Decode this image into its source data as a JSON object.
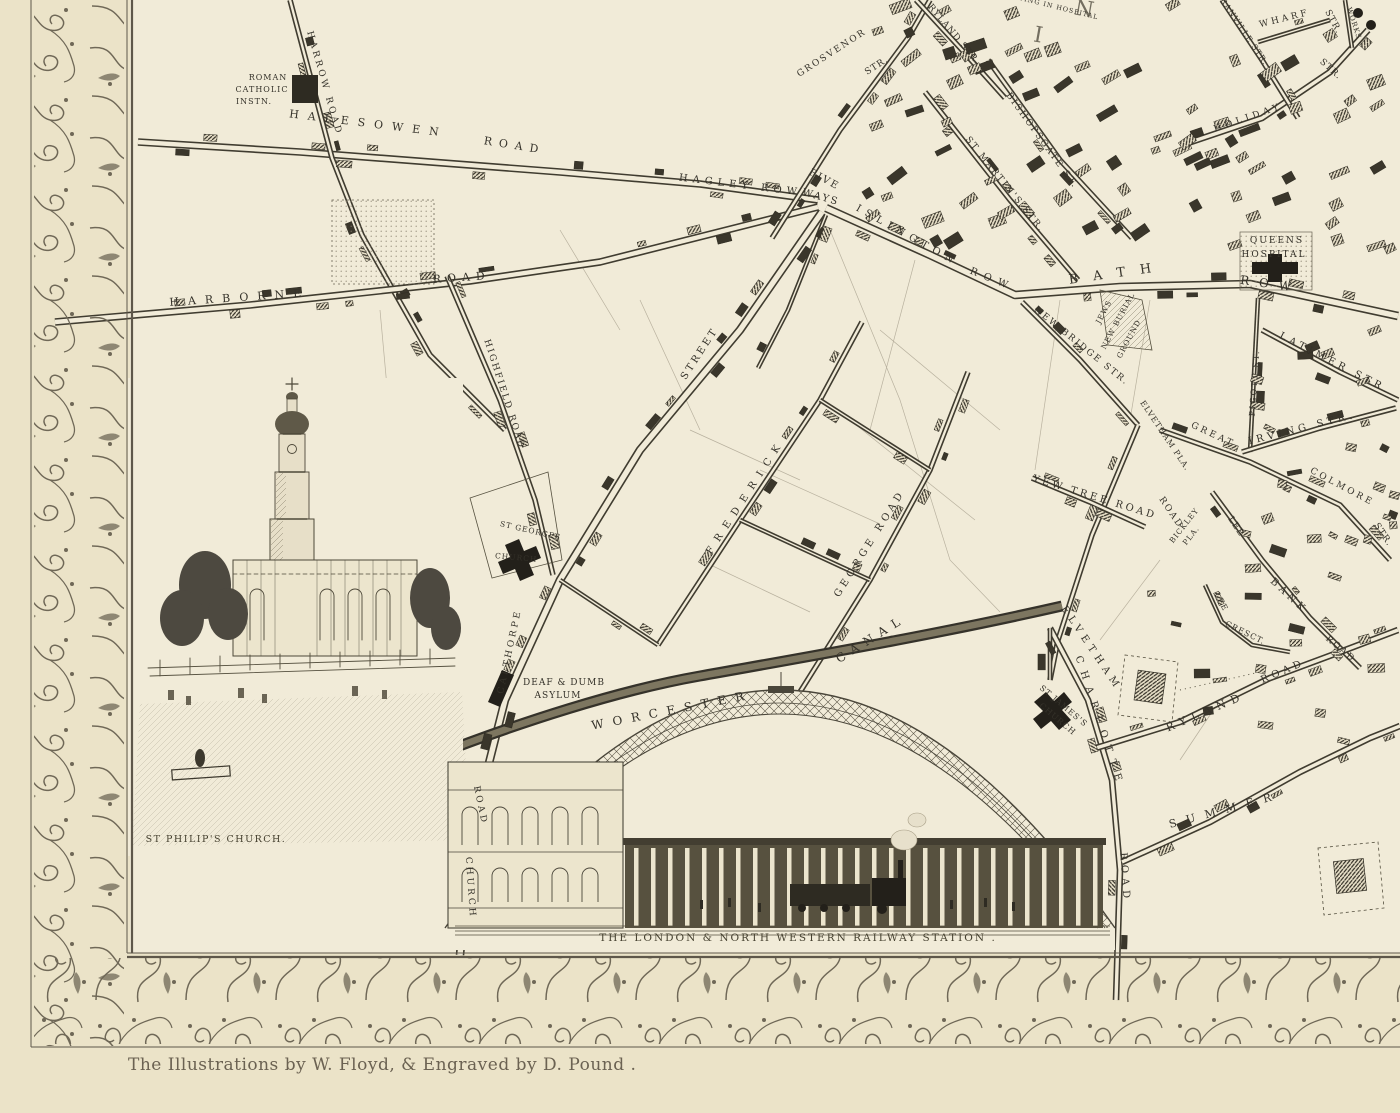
{
  "colors": {
    "paper": "#ebe3c8",
    "map_bg": "#f1ebd8",
    "ink": "#35322a",
    "border_ink": "#6f6857",
    "vignette_ink": "#4d4839"
  },
  "captions": {
    "church": "ST PHILIP'S CHURCH.",
    "station": "THE LONDON & NORTH WESTERN RAILWAY STATION .",
    "credit": "The Illustrations by W. Floyd, & Engraved by D. Pound ."
  },
  "map": {
    "labels": [
      {
        "t": "HARROW ROAD",
        "x": 322,
        "y": 84,
        "r": 74,
        "s": 9,
        "ls": 3
      },
      {
        "t": "HALESOWEN",
        "x": 368,
        "y": 127,
        "r": 7,
        "s": 11,
        "ls": 9
      },
      {
        "t": "ROAD",
        "x": 514,
        "y": 149,
        "r": 9,
        "s": 11,
        "ls": 7
      },
      {
        "t": "ROMAN",
        "x": 268,
        "y": 80,
        "r": 0,
        "s": 8,
        "ls": 1
      },
      {
        "t": "CATHOLIC",
        "x": 262,
        "y": 92,
        "r": 0,
        "s": 8,
        "ls": 1
      },
      {
        "t": "INSTN.",
        "x": 254,
        "y": 104,
        "r": 0,
        "s": 8,
        "ls": 1
      },
      {
        "t": "HAGLEY ROW",
        "x": 740,
        "y": 188,
        "r": 7,
        "s": 10,
        "ls": 5
      },
      {
        "t": "FIVE",
        "x": 823,
        "y": 182,
        "r": 28,
        "s": 10,
        "ls": 2
      },
      {
        "t": "WAYS",
        "x": 820,
        "y": 200,
        "r": 16,
        "s": 10,
        "ls": 2
      },
      {
        "t": "HARBORNE",
        "x": 240,
        "y": 301,
        "r": -4,
        "s": 11,
        "ls": 9
      },
      {
        "t": "ROAD",
        "x": 462,
        "y": 281,
        "r": -4,
        "s": 11,
        "ls": 6
      },
      {
        "t": "HIGHFIELD ROAD",
        "x": 502,
        "y": 395,
        "r": 72,
        "s": 9,
        "ls": 2
      },
      {
        "t": "GROSVENOR",
        "x": 833,
        "y": 55,
        "r": -33,
        "s": 9,
        "ls": 2
      },
      {
        "t": "STR.",
        "x": 878,
        "y": 68,
        "r": -33,
        "s": 9,
        "ls": 1
      },
      {
        "t": "RYLAND STR.",
        "x": 952,
        "y": 36,
        "r": 50,
        "s": 9,
        "ls": 1
      },
      {
        "t": "ST MARTIN'S STR.",
        "x": 1003,
        "y": 186,
        "r": 51,
        "s": 9,
        "ls": 2
      },
      {
        "t": "BISHOPSGATE ST.",
        "x": 1040,
        "y": 142,
        "r": 54,
        "s": 9,
        "ls": 2
      },
      {
        "t": "ISLINGTON",
        "x": 906,
        "y": 238,
        "r": 29,
        "s": 10,
        "ls": 6
      },
      {
        "t": "ROW",
        "x": 991,
        "y": 282,
        "r": 22,
        "s": 10,
        "ls": 7
      },
      {
        "t": "BATH",
        "x": 1118,
        "y": 277,
        "r": -8,
        "s": 13,
        "ls": 15
      },
      {
        "t": "ROW",
        "x": 1270,
        "y": 288,
        "r": 8,
        "s": 12,
        "ls": 10
      },
      {
        "t": "QUEENS",
        "x": 1277,
        "y": 243,
        "r": 0,
        "s": 9,
        "ls": 2
      },
      {
        "t": "HOSPITAL",
        "x": 1274,
        "y": 257,
        "r": 0,
        "s": 9,
        "ls": 2
      },
      {
        "t": "LYING IN HOSPITAL",
        "x": 1056,
        "y": 9,
        "r": 14,
        "s": 6.5,
        "ls": 1
      },
      {
        "t": "I",
        "x": 1037,
        "y": 42,
        "r": 10,
        "s": 22,
        "ls": 0,
        "cls": "big"
      },
      {
        "t": "N",
        "x": 1083,
        "y": 16,
        "r": 10,
        "s": 22,
        "ls": 0,
        "cls": "big"
      },
      {
        "t": "WHARF",
        "x": 1285,
        "y": 21,
        "r": -14,
        "s": 9,
        "ls": 3
      },
      {
        "t": "STR.",
        "x": 1331,
        "y": 23,
        "r": 62,
        "s": 9,
        "ls": 1
      },
      {
        "t": "HOLIDAY",
        "x": 1249,
        "y": 120,
        "r": -19,
        "s": 9,
        "ls": 4
      },
      {
        "t": "STR.",
        "x": 1329,
        "y": 71,
        "r": 42,
        "s": 9,
        "ls": 1
      },
      {
        "t": "GRANVILLE STR.",
        "x": 1240,
        "y": 30,
        "r": 56,
        "s": 8,
        "ls": 1
      },
      {
        "t": "WORKS",
        "x": 1352,
        "y": 24,
        "r": 72,
        "s": 7,
        "ls": 1
      },
      {
        "t": "NEW BRIDGE STR.",
        "x": 1080,
        "y": 348,
        "r": 39,
        "s": 9,
        "ls": 2
      },
      {
        "t": "JEWS",
        "x": 1106,
        "y": 313,
        "r": -62,
        "s": 7.5,
        "ls": 1
      },
      {
        "t": "NEW BURIAL",
        "x": 1120,
        "y": 322,
        "r": -62,
        "s": 7.5,
        "ls": 1
      },
      {
        "t": "GROUND",
        "x": 1131,
        "y": 340,
        "r": -62,
        "s": 7.5,
        "ls": 1
      },
      {
        "t": "ELVETHAM PLA.",
        "x": 1163,
        "y": 437,
        "r": 56,
        "s": 8,
        "ls": 1
      },
      {
        "t": "YEW TREE ROAD",
        "x": 1094,
        "y": 500,
        "r": 17,
        "s": 10,
        "ls": 3
      },
      {
        "t": "ROAD",
        "x": 1169,
        "y": 514,
        "r": 56,
        "s": 9,
        "ls": 2
      },
      {
        "t": "ELVETHAM",
        "x": 1089,
        "y": 650,
        "r": 56,
        "s": 10,
        "ls": 5
      },
      {
        "t": "BICKLEY",
        "x": 1186,
        "y": 527,
        "r": -52,
        "s": 7.5,
        "ls": 1
      },
      {
        "t": "PLA.",
        "x": 1193,
        "y": 537,
        "r": -52,
        "s": 7.5,
        "ls": 1
      },
      {
        "t": "IRVING STR.",
        "x": 1303,
        "y": 431,
        "r": -14,
        "s": 10,
        "ls": 4
      },
      {
        "t": "LATIMER STR.",
        "x": 1334,
        "y": 366,
        "r": 27,
        "s": 10,
        "ls": 4
      },
      {
        "t": "PIGOTT ST.",
        "x": 1257,
        "y": 383,
        "r": -86,
        "s": 8,
        "ls": 2
      },
      {
        "t": "GREAT",
        "x": 1212,
        "y": 437,
        "r": 25,
        "s": 9,
        "ls": 3
      },
      {
        "t": "COLMORE",
        "x": 1341,
        "y": 489,
        "r": 28,
        "s": 9,
        "ls": 3
      },
      {
        "t": "STR.",
        "x": 1381,
        "y": 536,
        "r": 56,
        "s": 9,
        "ls": 1
      },
      {
        "t": "LEE",
        "x": 1219,
        "y": 603,
        "r": 62,
        "s": 8,
        "ls": 1
      },
      {
        "t": "CRESCT.",
        "x": 1244,
        "y": 635,
        "r": 26,
        "s": 8,
        "ls": 1
      },
      {
        "t": "LEE",
        "x": 1234,
        "y": 528,
        "r": 56,
        "s": 9,
        "ls": 1
      },
      {
        "t": "BANK",
        "x": 1287,
        "y": 598,
        "r": 43,
        "s": 10,
        "ls": 4
      },
      {
        "t": "ROAD",
        "x": 1339,
        "y": 651,
        "r": 40,
        "s": 9,
        "ls": 2
      },
      {
        "t": "RYLAND",
        "x": 1207,
        "y": 715,
        "r": -23,
        "s": 11,
        "ls": 6
      },
      {
        "t": "ROAD",
        "x": 1284,
        "y": 674,
        "r": -23,
        "s": 10,
        "ls": 4
      },
      {
        "t": "CHARLOTTE",
        "x": 1097,
        "y": 723,
        "r": 72,
        "s": 10,
        "ls": 8
      },
      {
        "t": "ROAD",
        "x": 1122,
        "y": 878,
        "r": 86,
        "s": 10,
        "ls": 5
      },
      {
        "t": "SUMMER",
        "x": 1226,
        "y": 813,
        "r": -15,
        "s": 11,
        "ls": 10
      },
      {
        "t": "ST JAMES'S",
        "x": 1062,
        "y": 708,
        "r": 40,
        "s": 8,
        "ls": 1
      },
      {
        "t": "CHURCH",
        "x": 1056,
        "y": 721,
        "r": 40,
        "s": 8,
        "ls": 1
      },
      {
        "t": "WORCESTER",
        "x": 673,
        "y": 714,
        "r": -11,
        "s": 12,
        "ls": 9
      },
      {
        "t": "CANAL",
        "x": 873,
        "y": 642,
        "r": -32,
        "s": 12,
        "ls": 7
      },
      {
        "t": "CALTHORPE",
        "x": 512,
        "y": 652,
        "r": -78,
        "s": 9,
        "ls": 3
      },
      {
        "t": "CHURCH",
        "x": 468,
        "y": 888,
        "r": 86,
        "s": 9,
        "ls": 3
      },
      {
        "t": "ROAD",
        "x": 478,
        "y": 806,
        "r": 78,
        "s": 9,
        "ls": 3
      },
      {
        "t": "ST GEORGES",
        "x": 530,
        "y": 533,
        "r": 13,
        "s": 7.5,
        "ls": 1
      },
      {
        "t": "CHURCH",
        "x": 516,
        "y": 560,
        "r": 5,
        "s": 7.5,
        "ls": 1
      },
      {
        "t": "DEAF & DUMB",
        "x": 564,
        "y": 685,
        "r": 0,
        "s": 9,
        "ls": 1
      },
      {
        "t": "ASYLUM",
        "x": 558,
        "y": 698,
        "r": 0,
        "s": 9,
        "ls": 1
      },
      {
        "t": "FREDERICK",
        "x": 748,
        "y": 498,
        "r": -57,
        "s": 10,
        "ls": 8
      },
      {
        "t": "STREET",
        "x": 702,
        "y": 355,
        "r": -57,
        "s": 10,
        "ls": 3
      },
      {
        "t": "GEORGE ROAD",
        "x": 872,
        "y": 545,
        "r": -58,
        "s": 10,
        "ls": 4
      }
    ]
  }
}
